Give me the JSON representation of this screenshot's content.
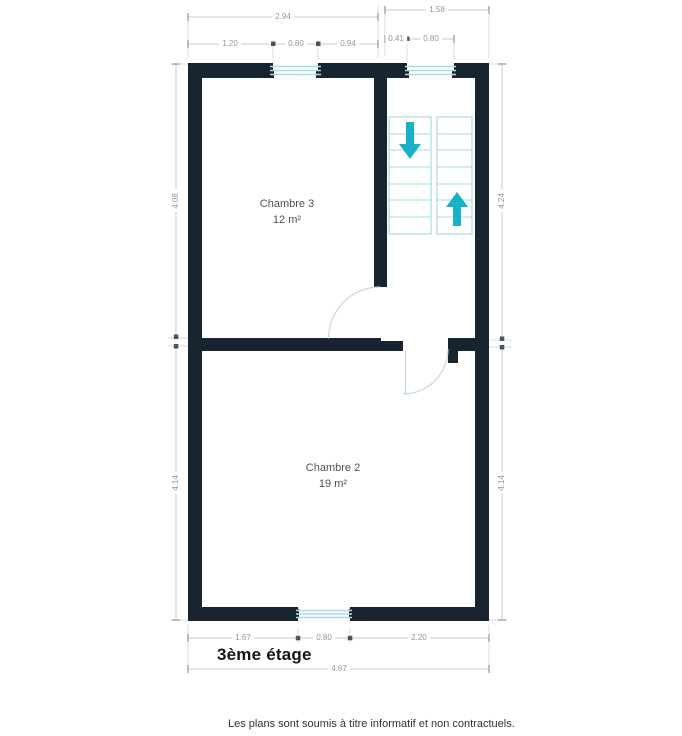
{
  "plan": {
    "floor_label": "3ème étage",
    "disclaimer": "Les plans sont soumis à titre informatif et non contractuels.",
    "rooms": {
      "chambre3": {
        "name": "Chambre 3",
        "area": "12 m²"
      },
      "chambre2": {
        "name": "Chambre 2",
        "area": "19 m²"
      }
    },
    "dims": {
      "top_total_left": "2.94",
      "top_total_right": "1.58",
      "top_left_seg1": "1.20",
      "top_left_seg2": "0.80",
      "top_left_seg3": "0.94",
      "top_right_seg1": "0.41",
      "top_right_seg2": "0.80",
      "left_upper": "4.08",
      "left_lower": "4.14",
      "right_upper": "4.24",
      "right_lower": "4.14",
      "bottom_seg1": "1.67",
      "bottom_seg2": "0.80",
      "bottom_seg3": "2.20",
      "bottom_total": "4.67"
    },
    "icons": {
      "stairs_down_arrow": "stairs-down-arrow",
      "stairs_up_arrow": "stairs-up-arrow"
    },
    "colors": {
      "wall": "#182531",
      "accent_teal": "#18b2c8",
      "stair_outline": "#a5dce2",
      "door_arc": "#c2dade",
      "dim_line": "#ccd1d5",
      "dim_text": "#8f979e"
    }
  }
}
